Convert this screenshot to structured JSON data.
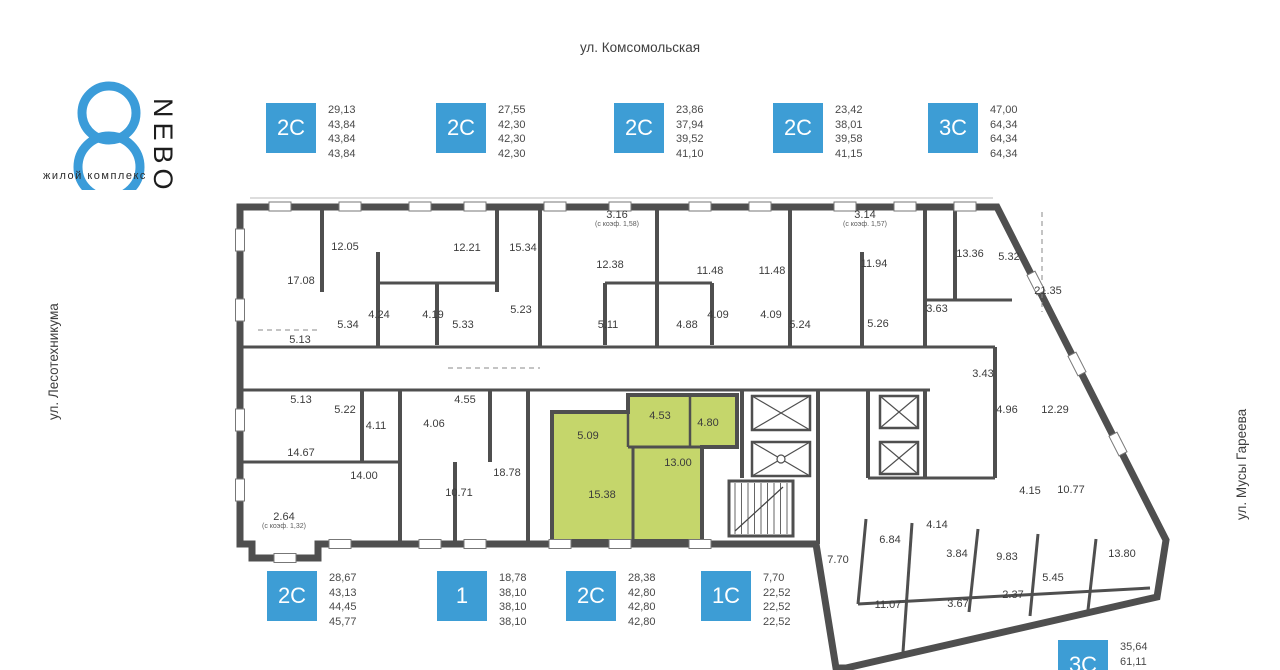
{
  "logo": {
    "name": "NEBO",
    "number": "8",
    "subtitle": "жилой комплекс"
  },
  "streets": {
    "top": "ул. Комсомольская",
    "left": "ул. Лесотехникума",
    "right": "ул. Мусы Гареева"
  },
  "colors": {
    "accent": "#3d9dd5",
    "highlight": "#c5d66b",
    "wall": "#4f4f4f"
  },
  "legend_top": [
    {
      "type": "2С",
      "areas": [
        "29,13",
        "43,84",
        "43,84",
        "43,84"
      ],
      "x": 266
    },
    {
      "type": "2С",
      "areas": [
        "27,55",
        "42,30",
        "42,30",
        "42,30"
      ],
      "x": 436
    },
    {
      "type": "2С",
      "areas": [
        "23,86",
        "37,94",
        "39,52",
        "41,10"
      ],
      "x": 614
    },
    {
      "type": "2С",
      "areas": [
        "23,42",
        "38,01",
        "39,58",
        "41,15"
      ],
      "x": 773
    },
    {
      "type": "3С",
      "areas": [
        "47,00",
        "64,34",
        "64,34",
        "64,34"
      ],
      "x": 928
    }
  ],
  "legend_bottom": [
    {
      "type": "2С",
      "areas": [
        "28,67",
        "43,13",
        "44,45",
        "45,77"
      ],
      "x": 267
    },
    {
      "type": "1",
      "areas": [
        "18,78",
        "38,10",
        "38,10",
        "38,10"
      ],
      "x": 437
    },
    {
      "type": "2С",
      "areas": [
        "28,38",
        "42,80",
        "42,80",
        "42,80"
      ],
      "x": 566
    },
    {
      "type": "1С",
      "areas": [
        "7,70",
        "22,52",
        "22,52",
        "22,52"
      ],
      "x": 701
    }
  ],
  "legend_corner": {
    "type": "3С",
    "areas": [
      "35,64",
      "61,11"
    ],
    "x": 1058,
    "y": 640
  },
  "plan": {
    "rooms": [
      {
        "label": "17.08",
        "x": 301,
        "y": 284
      },
      {
        "label": "12.05",
        "x": 345,
        "y": 250
      },
      {
        "label": "12.21",
        "x": 467,
        "y": 251
      },
      {
        "label": "15.34",
        "x": 523,
        "y": 251
      },
      {
        "label": "5.34",
        "x": 348,
        "y": 328
      },
      {
        "label": "4.24",
        "x": 379,
        "y": 318
      },
      {
        "label": "4.19",
        "x": 433,
        "y": 318
      },
      {
        "label": "5.33",
        "x": 463,
        "y": 328
      },
      {
        "label": "5.23",
        "x": 521,
        "y": 313
      },
      {
        "label": "5.13",
        "x": 300,
        "y": 343
      },
      {
        "label": "3.16",
        "sub": "(с коэф. 1,58)",
        "x": 617,
        "y": 218
      },
      {
        "label": "12.38",
        "x": 610,
        "y": 268
      },
      {
        "label": "11.48",
        "x": 710,
        "y": 274
      },
      {
        "label": "11.48",
        "x": 772,
        "y": 274
      },
      {
        "label": "3.14",
        "sub": "(с коэф. 1,57)",
        "x": 865,
        "y": 218
      },
      {
        "label": "11.94",
        "x": 874,
        "y": 267
      },
      {
        "label": "5.11",
        "x": 608,
        "y": 328
      },
      {
        "label": "4.88",
        "x": 687,
        "y": 328
      },
      {
        "label": "4.09",
        "x": 718,
        "y": 318
      },
      {
        "label": "4.09",
        "x": 771,
        "y": 318
      },
      {
        "label": "5.24",
        "x": 800,
        "y": 328
      },
      {
        "label": "5.26",
        "x": 878,
        "y": 327
      },
      {
        "label": "13.36",
        "x": 970,
        "y": 257
      },
      {
        "label": "5.32",
        "x": 1009,
        "y": 260
      },
      {
        "label": "21.35",
        "x": 1048,
        "y": 294
      },
      {
        "label": "3.63",
        "x": 937,
        "y": 312
      },
      {
        "label": "3.43",
        "x": 983,
        "y": 377
      },
      {
        "label": "4.96",
        "x": 1007,
        "y": 413
      },
      {
        "label": "12.29",
        "x": 1055,
        "y": 413
      },
      {
        "label": "4.15",
        "x": 1030,
        "y": 494
      },
      {
        "label": "10.77",
        "x": 1071,
        "y": 493
      },
      {
        "label": "5.13",
        "x": 301,
        "y": 403
      },
      {
        "label": "5.22",
        "x": 345,
        "y": 413
      },
      {
        "label": "4.11",
        "x": 376,
        "y": 429
      },
      {
        "label": "4.06",
        "x": 434,
        "y": 427
      },
      {
        "label": "4.55",
        "x": 465,
        "y": 403
      },
      {
        "label": "14.67",
        "x": 301,
        "y": 456
      },
      {
        "label": "14.00",
        "x": 364,
        "y": 479
      },
      {
        "label": "18.78",
        "x": 507,
        "y": 476
      },
      {
        "label": "10.71",
        "x": 459,
        "y": 496
      },
      {
        "label": "2.64",
        "sub": "(с коэф. 1,32)",
        "x": 284,
        "y": 520
      },
      {
        "label": "5.09",
        "x": 588,
        "y": 439,
        "hl": true
      },
      {
        "label": "4.53",
        "x": 660,
        "y": 419,
        "hl": true
      },
      {
        "label": "4.80",
        "x": 708,
        "y": 426,
        "hl": true
      },
      {
        "label": "13.00",
        "x": 678,
        "y": 466,
        "hl": true
      },
      {
        "label": "15.38",
        "x": 602,
        "y": 498,
        "hl": true
      },
      {
        "label": "7.70",
        "x": 838,
        "y": 563
      },
      {
        "label": "6.84",
        "x": 890,
        "y": 543
      },
      {
        "label": "4.14",
        "x": 937,
        "y": 528
      },
      {
        "label": "3.84",
        "x": 957,
        "y": 557
      },
      {
        "label": "9.83",
        "x": 1007,
        "y": 560
      },
      {
        "label": "2.37",
        "x": 1013,
        "y": 598
      },
      {
        "label": "5.45",
        "x": 1053,
        "y": 581
      },
      {
        "label": "13.80",
        "x": 1122,
        "y": 557
      },
      {
        "label": "11.07",
        "x": 888,
        "y": 608
      },
      {
        "label": "3.67",
        "x": 958,
        "y": 607
      }
    ]
  }
}
